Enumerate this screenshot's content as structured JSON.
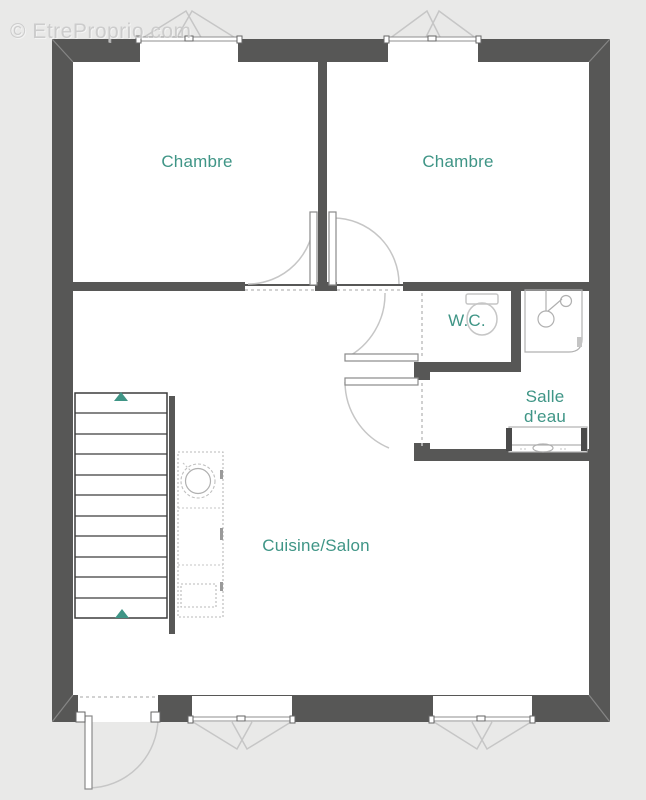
{
  "watermark": {
    "text": "© EtreProprio.com"
  },
  "rooms": {
    "bedroom1": {
      "label": "Chambre"
    },
    "bedroom2": {
      "label": "Chambre"
    },
    "wc": {
      "label": "W.C."
    },
    "shower_room": {
      "label": "Salle d'eau"
    },
    "kitchen_living": {
      "label": "Cuisine/Salon"
    }
  },
  "fixtures": {
    "staircase": "staircase-with-direction-arrows",
    "kitchen_unit": "kitchen-counter-with-round-sink",
    "toilet": "toilet-icon",
    "shower": "shower-tray-icon",
    "vanity": "vanity-sink-icon",
    "entrance_door": "entrance-door-swing",
    "interior_doors": [
      "bedroom1-door-swing",
      "bedroom2-door-swing",
      "wc-door-swing",
      "shower-room-door-swing"
    ],
    "windows": [
      "bedroom1-window",
      "bedroom2-window",
      "living-window-left",
      "living-window-right"
    ]
  },
  "colors": {
    "background": "#e9e9e8",
    "wall": "#575756",
    "floor": "#ffffff",
    "label": "#3f9586",
    "accent": "#3f9586",
    "fixture": "#c6c6c6",
    "stair": "#3c3c3c"
  }
}
